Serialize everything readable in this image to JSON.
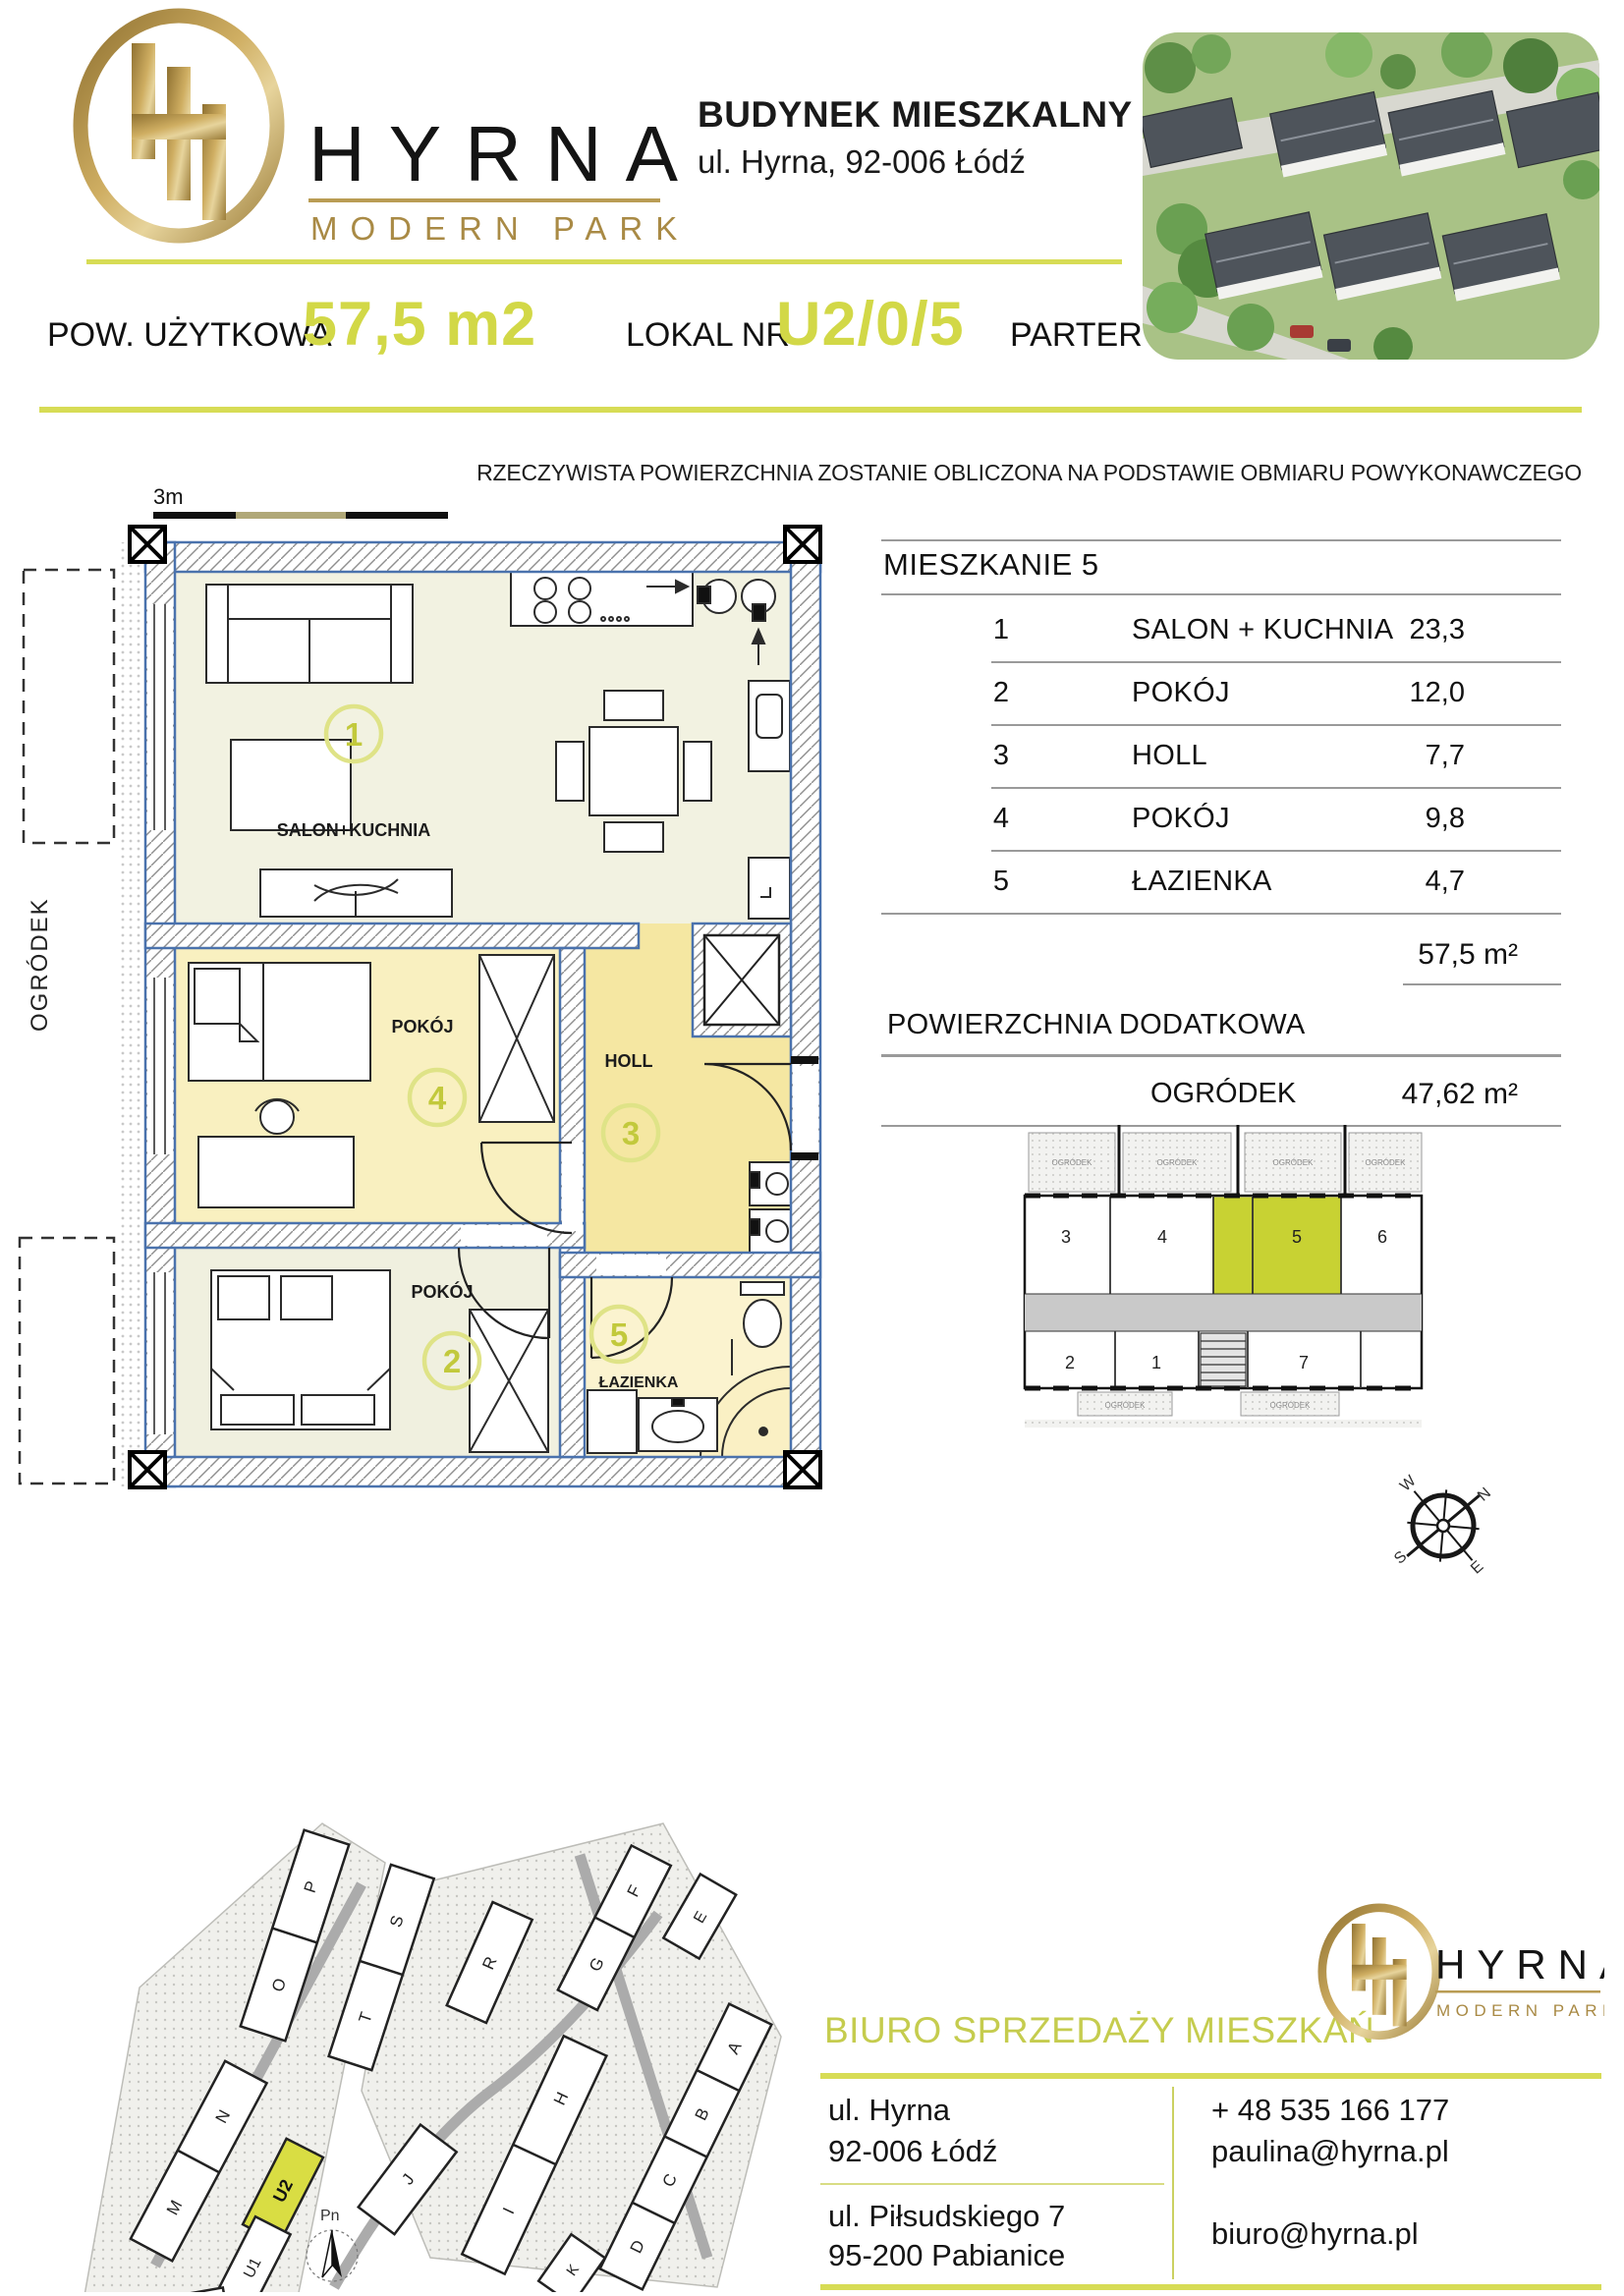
{
  "colors": {
    "accent": "#d2d847",
    "accent_light": "#dfe387",
    "unit_highlight": "#c8d233",
    "wall_blue": "#4a72ad",
    "gold": "#b3924c"
  },
  "header": {
    "logo": {
      "brand": "HYRNA",
      "tagline": "MODERN PARK"
    },
    "title": "BUDYNEK MIESZKALNY U2",
    "address": "ul. Hyrna, 92-006 Łódź"
  },
  "band": {
    "area_label": "POW. UŻYTKOWA",
    "area_value": "57,5 m2",
    "lokal_label": "LOKAL NR",
    "lokal_value": "U2/0/5",
    "floor_label": "PARTER"
  },
  "disclaimer": "RZECZYWISTA POWIERZCHNIA ZOSTANIE OBLICZONA NA PODSTAWIE OBMIARU POWYKONAWCZEGO",
  "plan": {
    "scale_label": "3m",
    "garden_side_label": "OGRÓDEK",
    "rooms": {
      "salon": {
        "num": "1",
        "label": "SALON+KUCHNIA"
      },
      "pokoj4": {
        "num": "4",
        "label": "POKÓJ"
      },
      "holl": {
        "num": "3",
        "label": "HOLL"
      },
      "pokoj2": {
        "num": "2",
        "label": "POKÓJ"
      },
      "lazienka": {
        "num": "5",
        "label": "ŁAZIENKA"
      }
    }
  },
  "room_table": {
    "title": "MIESZKANIE 5",
    "rows": [
      {
        "no": "1",
        "name": "SALON + KUCHNIA",
        "area": "23,3"
      },
      {
        "no": "2",
        "name": "POKÓJ",
        "area": "12,0"
      },
      {
        "no": "3",
        "name": "HOLL",
        "area": "7,7"
      },
      {
        "no": "4",
        "name": "POKÓJ",
        "area": "9,8"
      },
      {
        "no": "5",
        "name": "ŁAZIENKA",
        "area": "4,7"
      }
    ],
    "total_value": "57,5 m²",
    "extra_header": "POWIERZCHNIA DODATKOWA",
    "extra_name": "OGRÓDEK",
    "extra_value": "47,62 m²"
  },
  "floor_overview": {
    "garden_label": "OGRÓDEK",
    "units": {
      "u3": "3",
      "u4": "4",
      "u5": "5",
      "u6": "6",
      "u2": "2",
      "u1": "1",
      "u7": "7"
    },
    "highlighted_unit": "5"
  },
  "compass": {
    "n": "N",
    "e": "E",
    "s": "S",
    "w": "W"
  },
  "site_plan": {
    "north_label": "Pn",
    "highlighted_building": "U2",
    "buildings": [
      "P",
      "O",
      "S",
      "T",
      "R",
      "N",
      "M",
      "U2",
      "U1",
      "L1",
      "L2",
      "J",
      "H",
      "I",
      "K",
      "F",
      "G",
      "E",
      "A",
      "B",
      "C",
      "D"
    ]
  },
  "office": {
    "title": "BIURO SPRZEDAŻY MIESZKAŃ",
    "addr1_line1": "ul. Hyrna",
    "addr1_line2": "92-006 Łódź",
    "phone": "+ 48 535 166 177",
    "email1": "paulina@hyrna.pl",
    "addr2_line1": "ul. Piłsudskiego 7",
    "addr2_line2": "95-200 Pabianice",
    "email2": "biuro@hyrna.pl"
  }
}
